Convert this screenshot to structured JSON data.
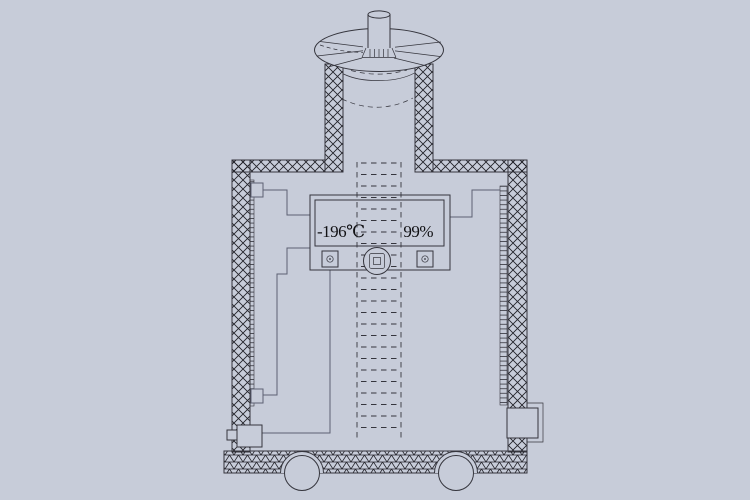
{
  "colors": {
    "background": "#c7ccd9",
    "line": "#35353d",
    "wire": "#5c6172",
    "hatch": "#23232a",
    "text": "#111114"
  },
  "display": {
    "temperature": "-196℃",
    "level": "99%"
  }
}
